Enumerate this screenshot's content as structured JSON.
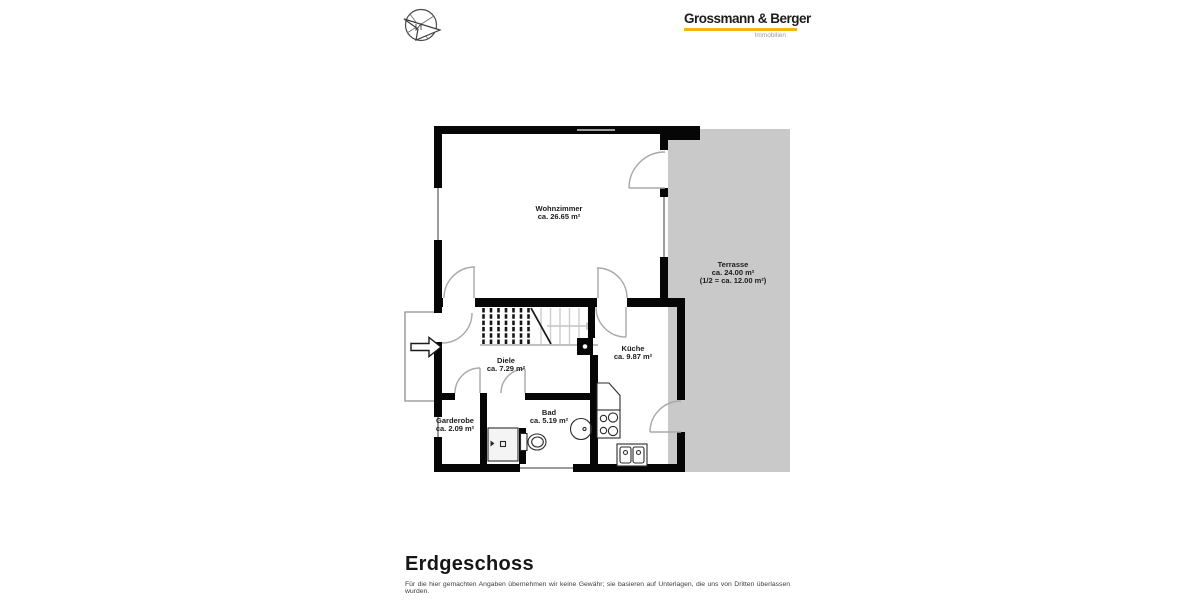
{
  "header": {
    "compass_icon": "compass-rose-icon",
    "logo_title": "Grossmann & Berger",
    "logo_subtitle": "Immobilien",
    "brand_yellow": "#f2b50f"
  },
  "floorplan": {
    "wall_color": "#060606",
    "terrace_fill": "#c9c9c9",
    "door_arc_color": "#a8a8a8",
    "window_color": "#9c9c9c",
    "rooms": [
      {
        "name": "Wohnzimmer",
        "area": "ca. 26.65 m²"
      },
      {
        "name": "Terrasse",
        "area": "ca. 24.00 m²",
        "area_note": "(1/2 = ca. 12.00 m²)"
      },
      {
        "name": "Küche",
        "area": "ca. 9.87 m²"
      },
      {
        "name": "Diele",
        "area": "ca. 7.29 m²"
      },
      {
        "name": "Bad",
        "area": "ca. 5.19 m²"
      },
      {
        "name": "Garderobe",
        "area": "ca. 2.09 m²"
      }
    ]
  },
  "footer": {
    "title": "Erdgeschoss",
    "disclaimer": "Für die hier gemachten Angaben übernehmen wir keine Gewähr; sie basieren auf Unterlagen, die uns von Dritten überlassen wurden."
  }
}
